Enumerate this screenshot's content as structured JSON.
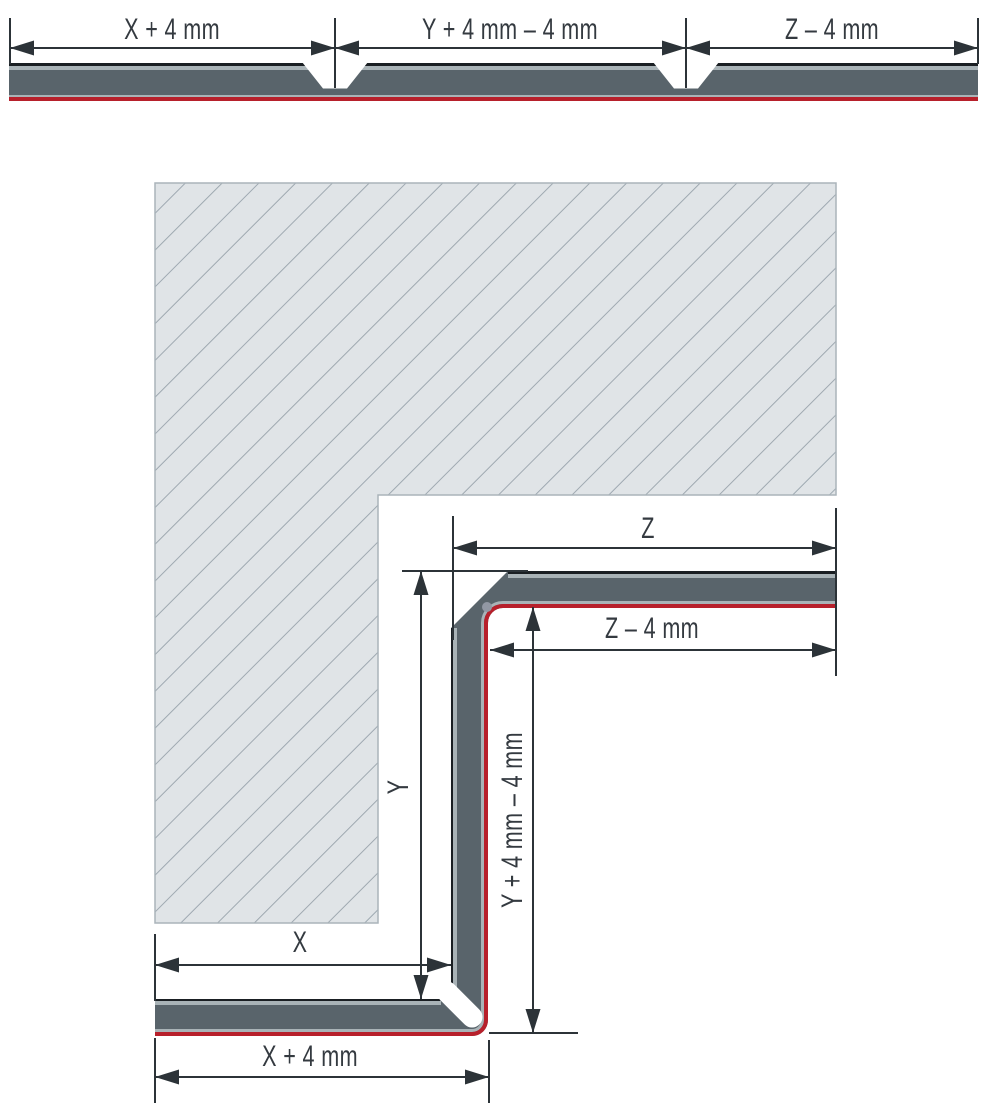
{
  "figure": {
    "top": {
      "label_x": "X + 4 mm",
      "label_y": "Y + 4 mm – 4 mm",
      "label_z": "Z – 4 mm"
    },
    "bottom": {
      "label_z": "Z",
      "label_z_minus": "Z – 4 mm",
      "label_y": "Y",
      "label_y_formula": "Y + 4 mm – 4 mm",
      "label_x": "X",
      "label_x_plus": "X + 4 mm"
    },
    "colors": {
      "panel_core": "#59646b",
      "panel_back_edge": "#1a1f23",
      "panel_liner": "#a9b3b7",
      "laminate_red": "#b7202b",
      "dimension_ink": "#2c3338",
      "substrate_fill": "#e0e4e7",
      "substrate_hatch_line": "#9fa9b1",
      "substrate_border": "#aab4ba",
      "groove_dot": "#9298a4"
    }
  }
}
